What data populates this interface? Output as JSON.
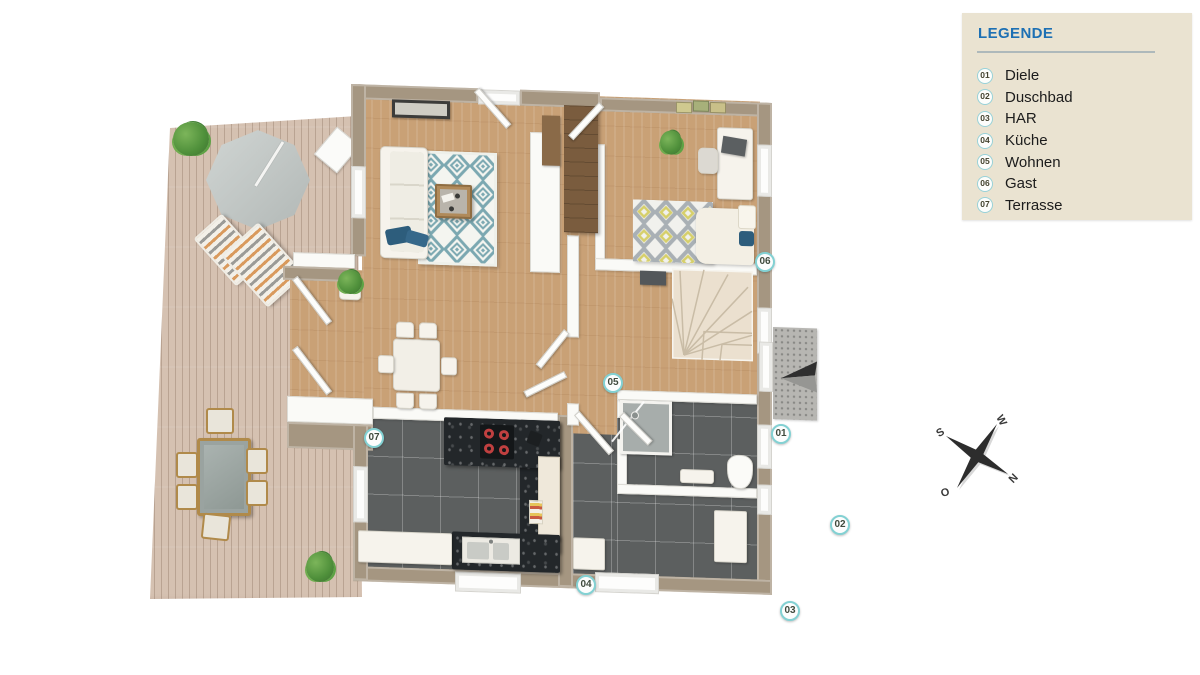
{
  "legend": {
    "title": "LEGENDE",
    "items": [
      {
        "number": "01",
        "label": "Diele"
      },
      {
        "number": "02",
        "label": "Duschbad"
      },
      {
        "number": "03",
        "label": "HAR"
      },
      {
        "number": "04",
        "label": "Küche"
      },
      {
        "number": "05",
        "label": "Wohnen"
      },
      {
        "number": "06",
        "label": "Gast"
      },
      {
        "number": "07",
        "label": "Terrasse"
      }
    ]
  },
  "plan": {
    "badges": [
      {
        "number": "01"
      },
      {
        "number": "02"
      },
      {
        "number": "03"
      },
      {
        "number": "04"
      },
      {
        "number": "05"
      },
      {
        "number": "06"
      },
      {
        "number": "07"
      }
    ]
  },
  "compass": {
    "n": "N",
    "e": "O",
    "s": "S",
    "w": "W"
  },
  "colors": {
    "legend_bg": "#eae3d1",
    "accent_blue": "#1d70b4",
    "badge_ring": "#83d1d3",
    "badge_text": "#3f4a3d",
    "wall_taupe": "#a59681",
    "wood_floor": "#c9a176",
    "deck_wood": "#d5c1b1",
    "dark_tile": "#5c5f5f",
    "rug_teal": "#7ba8b1",
    "bed_yellow": "#d6cf6a",
    "bed_gray": "#a9b0b5",
    "pillow_blue": "#2d5d7c",
    "burner_red": "#c04040"
  }
}
